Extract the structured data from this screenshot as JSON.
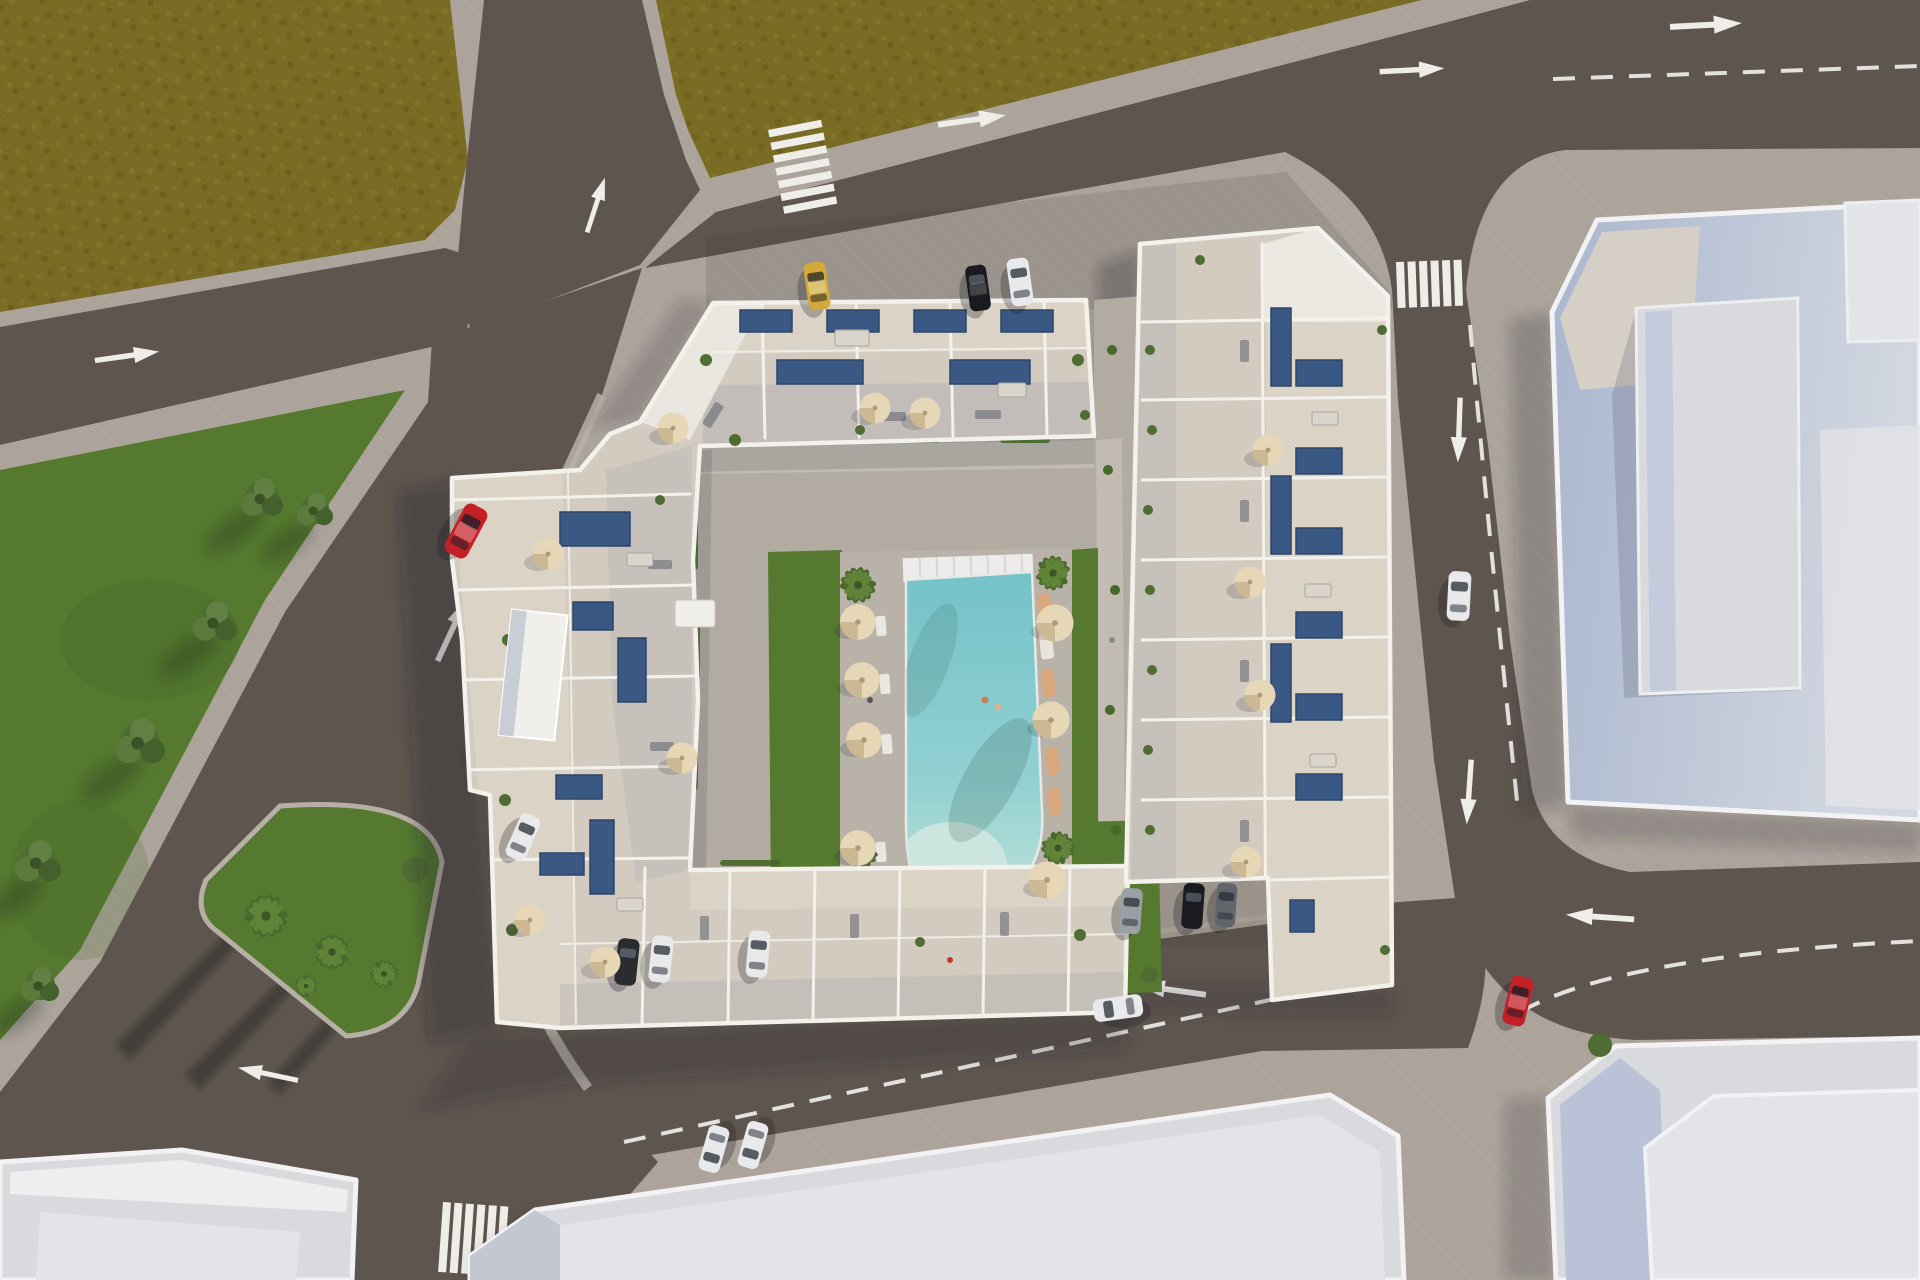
{
  "scene": {
    "type": "aerial-3d-architectural-render",
    "subject": "Residential apartment complex with rooftop terraces and solar panels around a courtyard swimming pool, surrounded by streets with road markings, parked and moving cars, lawns, palm trees and neighboring flat-roof buildings",
    "camera": "top-down aerial with slight perspective",
    "colors": {
      "pavement": "#aca49b",
      "pavement_light": "#bcb4aa",
      "road": "#5e564e",
      "marking": "#efede8",
      "field": "#7a6c24",
      "field_dark": "#695d1e",
      "field_light": "#8b7c2d",
      "grass": "#55792f",
      "grass_dark": "#466828",
      "foliage": "#4f6c33",
      "palm": "#5f8438",
      "wall_white": "#f3f1ec",
      "wall_shadow": "#97a2b4",
      "terrace": "#d3cbc0",
      "terrace_cream": "#dbd3c6",
      "terrace_gray": "#c6c0b8",
      "courtyard": "#b2aba2",
      "path": "#c2bbb1",
      "pool": "#7ec7cd",
      "pool_shallow": "#cfe7e0",
      "solar": "#3a5884",
      "solar_light": "#5b7cab",
      "umbrella": "#e6d7b6",
      "umbrella_shade": "#cdb894",
      "lounger": "#d9a77c",
      "building_roof": "#d9dade",
      "building_side": "#b6c0d5",
      "building_white": "#f2f2f4",
      "building_roof2": "#e3e4e8",
      "car_red": "#c42127",
      "car_yellow": "#d2a93a",
      "car_white": "#e8e9eb",
      "car_black": "#1a1b1f",
      "car_silver": "#9aa0a6",
      "car_gray": "#62666c"
    },
    "landscape": {
      "olive_fields": 2,
      "lawns": 2,
      "trees": 6,
      "palm_trees": 10,
      "traffic_island": 1
    },
    "streets": {
      "roads": 6,
      "crosswalks": 3,
      "lane_arrows": 11,
      "dashed_lane_lines": 4
    },
    "vehicles": [
      {
        "id": "car-red-west-road",
        "color": "car_red"
      },
      {
        "id": "car-yellow-north-parking",
        "color": "car_yellow"
      },
      {
        "id": "car-black-north-parking",
        "color": "car_black"
      },
      {
        "id": "car-white-north-parking",
        "color": "car_white"
      },
      {
        "id": "car-white-west-curb",
        "color": "car_white"
      },
      {
        "id": "car-dark-south-bay",
        "color": "car_black"
      },
      {
        "id": "car-white-south-bay-1",
        "color": "car_white"
      },
      {
        "id": "car-white-south-bay-2",
        "color": "car_white"
      },
      {
        "id": "car-white-east-road",
        "color": "car_white"
      },
      {
        "id": "car-red-southeast-road",
        "color": "car_red"
      },
      {
        "id": "car-white-south-road-moving",
        "color": "car_white"
      },
      {
        "id": "car-silver-east-bay",
        "color": "car_silver"
      },
      {
        "id": "car-black-east-bay",
        "color": "car_black"
      },
      {
        "id": "car-gray-east-bay",
        "color": "car_gray"
      },
      {
        "id": "car-white-south-pair-1",
        "color": "car_white"
      },
      {
        "id": "car-white-south-pair-2",
        "color": "car_white"
      }
    ],
    "complex": {
      "blocks": 2,
      "solar_panel_arrays": 22,
      "umbrellas": 18,
      "sun_loungers": 6,
      "pool": 1,
      "playground": 1,
      "utility_kiosk": 1,
      "rooftop_terraces": "subdivided by white parapet walls"
    },
    "neighboring_buildings": 4
  }
}
